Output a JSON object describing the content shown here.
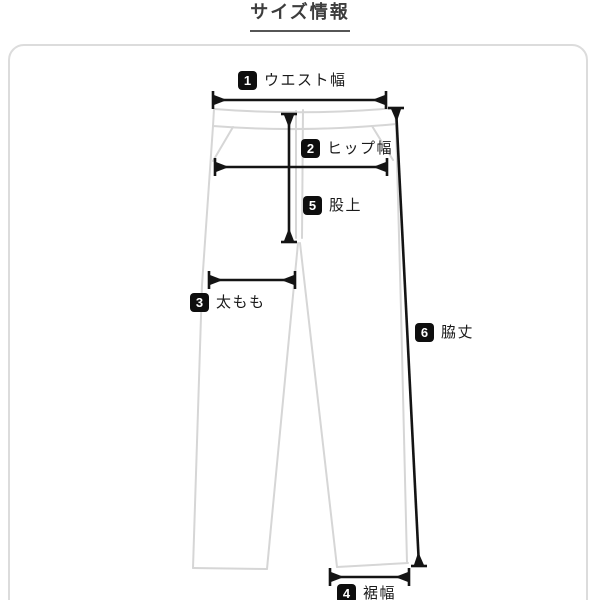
{
  "title": {
    "text": "サイズ情報"
  },
  "diagram": {
    "labels": [
      {
        "num": "1",
        "text": "ウエスト幅"
      },
      {
        "num": "2",
        "text": "ヒップ幅"
      },
      {
        "num": "3",
        "text": "太もも"
      },
      {
        "num": "4",
        "text": "裾幅"
      },
      {
        "num": "5",
        "text": "股上"
      },
      {
        "num": "6",
        "text": "脇丈"
      }
    ],
    "colors": {
      "outline": "#d6d6d6",
      "arrow": "#141414",
      "badge_bg": "#0e0e0e",
      "badge_text": "#ffffff",
      "frame_border": "#dcdcdc",
      "title_text": "#3d3d3d",
      "title_underline": "#565656"
    }
  }
}
